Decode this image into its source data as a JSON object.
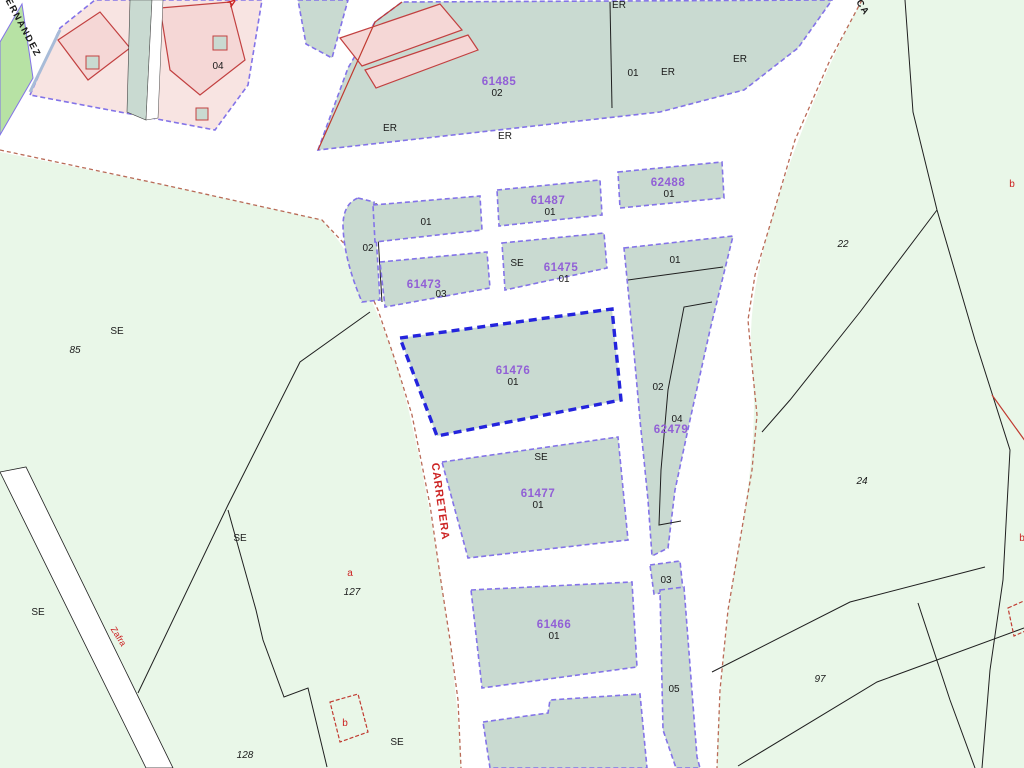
{
  "map": {
    "type": "cadastral-map",
    "colors": {
      "road": "#ffffff",
      "rural_fill": "#e9f7e8",
      "urban_block_fill": "#c9dad1",
      "block_border": "#8373e8",
      "selected_border": "#2424dd",
      "building_fill": "#f5d7d6",
      "building_outline": "#c24040",
      "rural_road_edge": "#b96b57",
      "code_label": "#915fd6",
      "red_label": "#cc2222"
    },
    "labels": {
      "codes": {
        "c61485": "61485",
        "c61487": "61487",
        "c62488": "62488",
        "c61473": "61473",
        "c61475": "61475",
        "c61476": "61476",
        "c62479": "62479",
        "c61477": "61477",
        "c61466": "61466"
      },
      "sub": {
        "n01": "01",
        "n02": "02",
        "n03": "03",
        "n04": "04",
        "n05": "05",
        "er": "ER",
        "se": "SE"
      },
      "rural": {
        "n22": "22",
        "n24": "24",
        "n85": "85",
        "n97": "97",
        "n127": "127",
        "n128": "128"
      },
      "red": {
        "a": "a",
        "b": "b",
        "carretera": "CARRETERA",
        "zafra": "Zafra",
        "la": "LA"
      },
      "streets": {
        "fernandez": "FERNANDEZ",
        "ca": "CA"
      }
    }
  }
}
